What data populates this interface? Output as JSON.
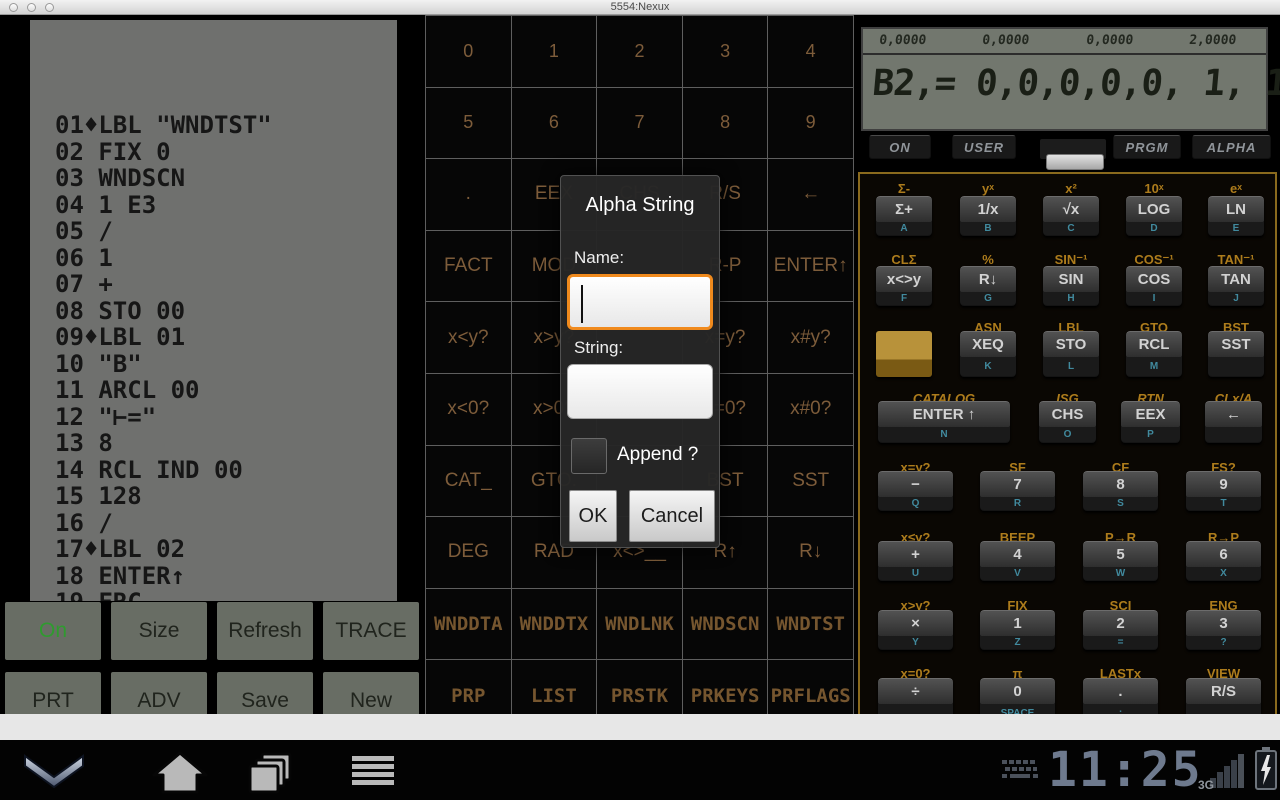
{
  "window": {
    "title": "5554:Nexux"
  },
  "colors": {
    "accent_orange": "#f08a1d",
    "grid_label": "#7d5c3a",
    "keypad_gold": "#ad7c1c",
    "key_sub_teal": "#418a9e",
    "on_green": "#2f9b2f",
    "clock_blue_gray": "#6e7a8e"
  },
  "program_display": {
    "lines": [
      "01♦LBL \"WNDTST\"",
      "02 FIX 0",
      "03 WNDSCN",
      "04 1 E3",
      "05 /",
      "06 1",
      "07 +",
      "08 STO 00",
      "09♦LBL 01",
      "10 \"B\"",
      "11 ARCL 00",
      "12 \"⊢=\"",
      "13 8",
      "14 RCL IND 00",
      "15 128",
      "16 /",
      "17♦LBL 02",
      "18 ENTER↑",
      "19 FRC"
    ]
  },
  "function_grid": {
    "rows": [
      {
        "style": "num",
        "cells": [
          "0",
          "1",
          "2",
          "3",
          "4"
        ]
      },
      {
        "style": "num",
        "cells": [
          "5",
          "6",
          "7",
          "8",
          "9"
        ]
      },
      {
        "style": "fn",
        "cells": [
          ".",
          "EEX",
          "CHS",
          "R/S",
          "←"
        ]
      },
      {
        "style": "fn",
        "cells": [
          "FACT",
          "MOD",
          "",
          "R-P",
          "ENTER↑"
        ]
      },
      {
        "style": "fn",
        "cells": [
          "x<y?",
          "x>y?",
          "",
          "x=y?",
          "x#y?"
        ]
      },
      {
        "style": "fn",
        "cells": [
          "x<0?",
          "x>0?",
          "",
          "x=0?",
          "x#0?"
        ]
      },
      {
        "style": "fn",
        "cells": [
          "CAT_",
          "GTO.",
          "",
          "BST",
          "SST"
        ]
      },
      {
        "style": "fn",
        "cells": [
          "DEG",
          "RAD",
          "x<>__",
          "R↑",
          "R↓"
        ]
      },
      {
        "style": "dot",
        "cells": [
          "WNDDTA",
          "WNDDTX",
          "WNDLNK",
          "WNDSCN",
          "WNDTST"
        ]
      },
      {
        "style": "dot",
        "cells": [
          "PRP",
          "LIST",
          "PRSTK",
          "PRKEYS",
          "PRFLAGS"
        ]
      }
    ]
  },
  "printer_panel": {
    "rows": [
      [
        "On",
        "Size",
        "Refresh",
        "TRACE"
      ],
      [
        "PRT",
        "ADV",
        "Save",
        "New"
      ]
    ],
    "on_button_index": 0
  },
  "dialog": {
    "title": "Alpha String",
    "name_label": "Name:",
    "name_value": "",
    "string_label": "String:",
    "string_value": "",
    "append_label": "Append ?",
    "append_checked": false,
    "ok_label": "OK",
    "cancel_label": "Cancel"
  },
  "calculator": {
    "stack_values": [
      "0,0000",
      "0,0000",
      "0,0000",
      "2,0000"
    ],
    "main_display": "B2,= 0,0,0,0,0, 1, 1,0,",
    "mode_buttons": [
      "ON",
      "USER",
      "PRGM",
      "ALPHA"
    ],
    "keypad_rows": [
      {
        "layout": "five",
        "shifts": [
          "Σ-",
          "yˣ",
          "x²",
          "10ˣ",
          "eˣ"
        ],
        "keys": [
          {
            "label": "Σ+",
            "sub": "A"
          },
          {
            "label": "1/x",
            "sub": "B"
          },
          {
            "label": "√x",
            "sub": "C"
          },
          {
            "label": "LOG",
            "sub": "D"
          },
          {
            "label": "LN",
            "sub": "E"
          }
        ]
      },
      {
        "layout": "five",
        "shifts": [
          "CLΣ",
          "%",
          "SIN⁻¹",
          "COS⁻¹",
          "TAN⁻¹"
        ],
        "keys": [
          {
            "label": "x<>y",
            "sub": "F"
          },
          {
            "label": "R↓",
            "sub": "G"
          },
          {
            "label": "SIN",
            "sub": "H"
          },
          {
            "label": "COS",
            "sub": "I"
          },
          {
            "label": "TAN",
            "sub": "J"
          }
        ]
      },
      {
        "layout": "five",
        "shifts": [
          "",
          "ASN",
          "LBL",
          "GTO",
          "BST"
        ],
        "keys": [
          {
            "type": "shift",
            "label": "",
            "sub": ""
          },
          {
            "label": "XEQ",
            "sub": "K"
          },
          {
            "label": "STO",
            "sub": "L"
          },
          {
            "label": "RCL",
            "sub": "M"
          },
          {
            "label": "SST",
            "sub": ""
          }
        ]
      },
      {
        "layout": "enter",
        "italic": true,
        "shifts": [
          "CATALOG",
          "ISG",
          "RTN",
          "CLx/A"
        ],
        "keys": [
          {
            "label": "ENTER ↑",
            "sub": "N"
          },
          {
            "label": "CHS",
            "sub": "O"
          },
          {
            "label": "EEX",
            "sub": "P"
          },
          {
            "label": "←",
            "sub": ""
          }
        ]
      },
      {
        "layout": "four",
        "shifts": [
          "x=y?",
          "SF",
          "CF",
          "FS?"
        ],
        "keys": [
          {
            "label": "−",
            "sub": "Q"
          },
          {
            "label": "7",
            "sub": "R"
          },
          {
            "label": "8",
            "sub": "S"
          },
          {
            "label": "9",
            "sub": "T"
          }
        ]
      },
      {
        "layout": "four",
        "shifts": [
          "x≤y?",
          "BEEP",
          "P→R",
          "R→P"
        ],
        "keys": [
          {
            "label": "+",
            "sub": "U"
          },
          {
            "label": "4",
            "sub": "V"
          },
          {
            "label": "5",
            "sub": "W"
          },
          {
            "label": "6",
            "sub": "X"
          }
        ]
      },
      {
        "layout": "four",
        "shifts": [
          "x>y?",
          "FIX",
          "SCI",
          "ENG"
        ],
        "keys": [
          {
            "label": "×",
            "sub": "Y"
          },
          {
            "label": "1",
            "sub": "Z"
          },
          {
            "label": "2",
            "sub": "="
          },
          {
            "label": "3",
            "sub": "?"
          }
        ]
      },
      {
        "layout": "four",
        "shifts": [
          "x=0?",
          "π",
          "LASTx",
          "VIEW"
        ],
        "keys": [
          {
            "label": "÷",
            "sub": ","
          },
          {
            "label": "0",
            "sub": "SPACE"
          },
          {
            "label": ".",
            "sub": ":"
          },
          {
            "label": "R/S",
            "sub": ""
          }
        ]
      }
    ]
  },
  "navbar": {
    "time": "11:25",
    "network_label": "3G"
  }
}
